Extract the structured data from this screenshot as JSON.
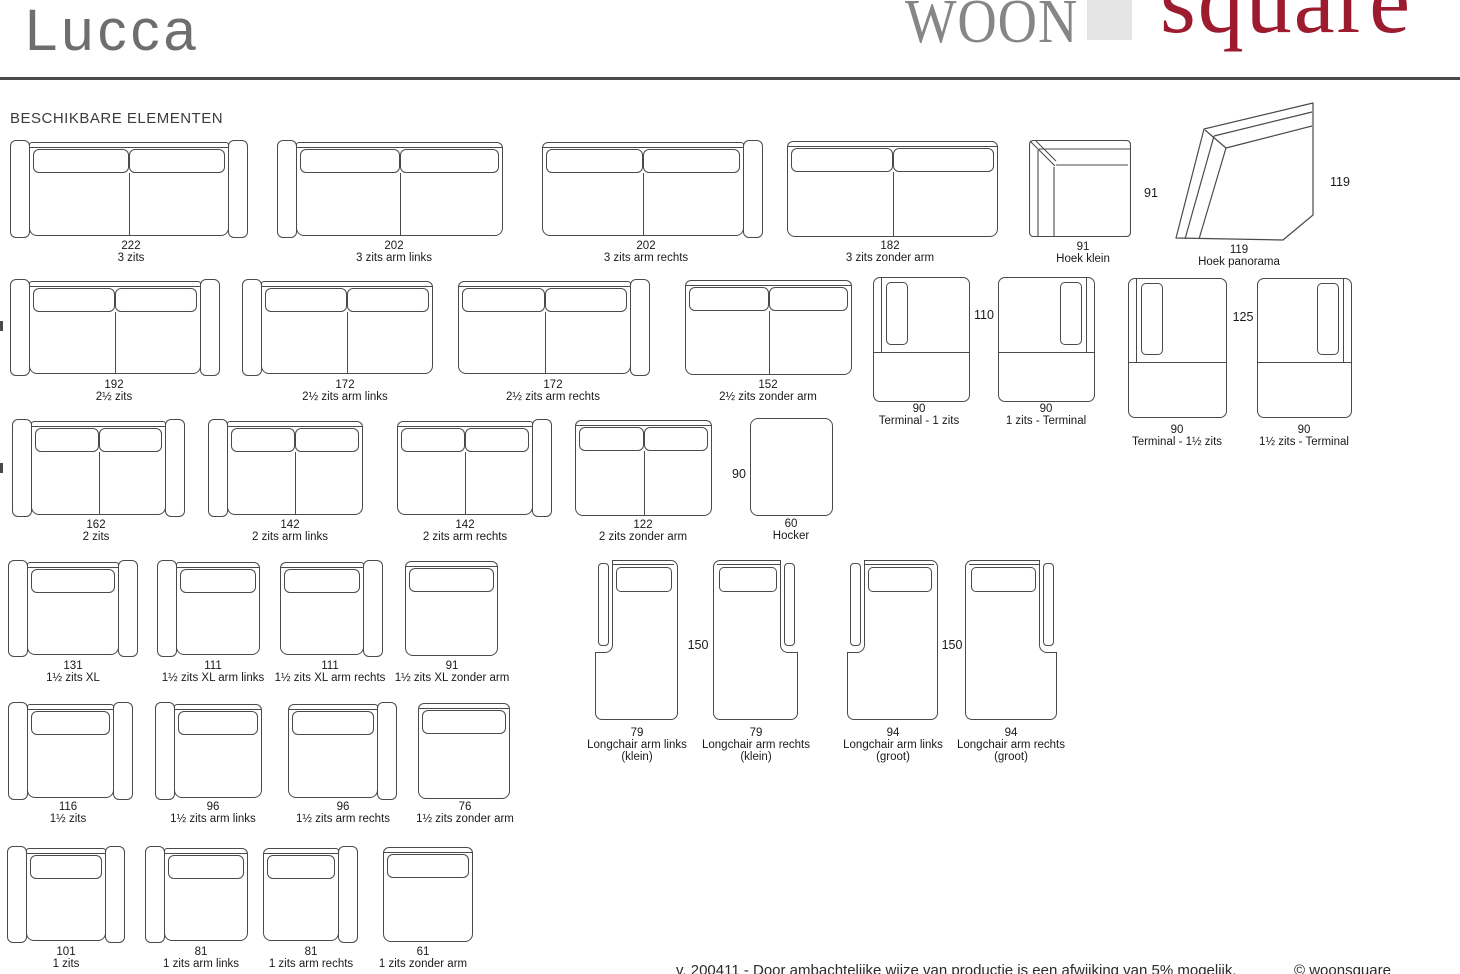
{
  "header": {
    "product_title": "Lucca",
    "brand_woon": "WOON",
    "brand_square": "square",
    "brand_red": "#9c1b2e",
    "brand_gray": "#868686"
  },
  "section": {
    "title": "BESCHIKBARE ELEMENTEN"
  },
  "footer": {
    "note": "v. 200411 - Door ambachtelijke wijze van productie is een afwijking van 5% mogelijk.",
    "copyright": "© woonsquare"
  },
  "diagram": {
    "line_color": "#4a4a4a",
    "items": [
      {
        "type": "sofa",
        "x": 10,
        "y": 140,
        "w": 238,
        "h": 98,
        "arms": "both",
        "cushions": 2,
        "size": "222",
        "name": "3 zits",
        "label_cx": 131,
        "label_y": 240
      },
      {
        "type": "sofa",
        "x": 277,
        "y": 140,
        "w": 226,
        "h": 98,
        "arms": "left",
        "cushions": 2,
        "size": "202",
        "name": "3 zits arm links",
        "label_cx": 394,
        "label_y": 240
      },
      {
        "type": "sofa",
        "x": 542,
        "y": 140,
        "w": 221,
        "h": 98,
        "arms": "right",
        "cushions": 2,
        "size": "202",
        "name": "3 zits arm rechts",
        "label_cx": 646,
        "label_y": 240
      },
      {
        "type": "sofa",
        "x": 787,
        "y": 140,
        "w": 211,
        "h": 98,
        "arms": "none",
        "cushions": 2,
        "size": "182",
        "name": "3 zits zonder arm",
        "label_cx": 890,
        "label_y": 240
      },
      {
        "type": "corner_klein",
        "x": 1029,
        "y": 140,
        "w": 102,
        "h": 97,
        "size": "91",
        "name": "Hoek klein",
        "label_cx": 1083,
        "label_y": 241,
        "side_dim": {
          "text": "91",
          "cx": 1151,
          "cy": 193
        }
      },
      {
        "type": "corner_panorama",
        "x": 1172,
        "y": 98,
        "w": 146,
        "h": 148,
        "size": "119",
        "name": "Hoek panorama",
        "label_cx": 1239,
        "label_y": 244,
        "side_dim": {
          "text": "119",
          "cx": 1340,
          "cy": 182
        }
      },
      {
        "type": "sofa",
        "x": 10,
        "y": 279,
        "w": 210,
        "h": 97,
        "arms": "both",
        "cushions": 2,
        "size": "192",
        "name": "2½ zits",
        "label_cx": 114,
        "label_y": 379
      },
      {
        "type": "sofa",
        "x": 242,
        "y": 279,
        "w": 191,
        "h": 97,
        "arms": "left",
        "cushions": 2,
        "size": "172",
        "name": "2½ zits arm links",
        "label_cx": 345,
        "label_y": 379
      },
      {
        "type": "sofa",
        "x": 458,
        "y": 279,
        "w": 192,
        "h": 97,
        "arms": "right",
        "cushions": 2,
        "size": "172",
        "name": "2½ zits arm rechts",
        "label_cx": 553,
        "label_y": 379
      },
      {
        "type": "sofa",
        "x": 685,
        "y": 279,
        "w": 167,
        "h": 97,
        "arms": "none",
        "cushions": 2,
        "size": "152",
        "name": "2½ zits zonder arm",
        "label_cx": 768,
        "label_y": 379
      },
      {
        "type": "terminal",
        "x": 873,
        "y": 277,
        "w": 97,
        "h": 125,
        "arm": "left",
        "size": "90",
        "name": "Terminal - 1 zits",
        "label_cx": 919,
        "label_y": 403,
        "side_dim": {
          "text": "110",
          "cx": 984,
          "cy": 315
        }
      },
      {
        "type": "terminal",
        "x": 998,
        "y": 277,
        "w": 97,
        "h": 125,
        "arm": "right",
        "size": "90",
        "name": "1 zits - Terminal",
        "label_cx": 1046,
        "label_y": 403
      },
      {
        "type": "terminal",
        "x": 1128,
        "y": 278,
        "w": 99,
        "h": 140,
        "arm": "left",
        "size": "90",
        "name": "Terminal - 1½ zits",
        "label_cx": 1177,
        "label_y": 424,
        "side_dim": {
          "text": "125",
          "cx": 1243,
          "cy": 317
        }
      },
      {
        "type": "terminal",
        "x": 1257,
        "y": 278,
        "w": 95,
        "h": 140,
        "arm": "right",
        "size": "90",
        "name": "1½ zits - Terminal",
        "label_cx": 1304,
        "label_y": 424
      },
      {
        "type": "sofa",
        "x": 12,
        "y": 419,
        "w": 173,
        "h": 98,
        "arms": "both",
        "cushions": 2,
        "size": "162",
        "name": "2 zits",
        "label_cx": 96,
        "label_y": 519
      },
      {
        "type": "sofa",
        "x": 208,
        "y": 419,
        "w": 155,
        "h": 98,
        "arms": "left",
        "cushions": 2,
        "size": "142",
        "name": "2 zits arm links",
        "label_cx": 290,
        "label_y": 519
      },
      {
        "type": "sofa",
        "x": 397,
        "y": 419,
        "w": 155,
        "h": 98,
        "arms": "right",
        "cushions": 2,
        "size": "142",
        "name": "2 zits arm rechts",
        "label_cx": 465,
        "label_y": 519
      },
      {
        "type": "sofa",
        "x": 575,
        "y": 419,
        "w": 137,
        "h": 98,
        "arms": "none",
        "cushions": 2,
        "size": "122",
        "name": "2 zits zonder arm",
        "label_cx": 643,
        "label_y": 519
      },
      {
        "type": "hocker",
        "x": 750,
        "y": 418,
        "w": 83,
        "h": 98,
        "size": "60",
        "name": "Hocker",
        "label_cx": 791,
        "label_y": 518,
        "side_dim": {
          "text": "90",
          "cx": 739,
          "cy": 474
        }
      },
      {
        "type": "sofa",
        "x": 8,
        "y": 560,
        "w": 130,
        "h": 97,
        "arms": "both",
        "cushions": 1,
        "size": "131",
        "name": "1½ zits XL",
        "label_cx": 73,
        "label_y": 660
      },
      {
        "type": "sofa",
        "x": 157,
        "y": 560,
        "w": 103,
        "h": 97,
        "arms": "left",
        "cushions": 1,
        "size": "111",
        "name": "1½ zits XL arm links",
        "label_cx": 213,
        "label_y": 660
      },
      {
        "type": "sofa",
        "x": 280,
        "y": 560,
        "w": 103,
        "h": 97,
        "arms": "right",
        "cushions": 1,
        "size": "111",
        "name": "1½ zits XL arm rechts",
        "label_cx": 330,
        "label_y": 660
      },
      {
        "type": "sofa",
        "x": 405,
        "y": 560,
        "w": 93,
        "h": 97,
        "arms": "none",
        "cushions": 1,
        "size": "91",
        "name": "1½ zits XL zonder arm",
        "label_cx": 452,
        "label_y": 660
      },
      {
        "type": "longchair",
        "x": 595,
        "y": 560,
        "w": 83,
        "h": 160,
        "arm": "left",
        "size": "79",
        "name": "Longchair arm links",
        "name2": "(klein)",
        "label_cx": 637,
        "label_y": 727,
        "side_dim": {
          "text": "150",
          "cx": 698,
          "cy": 645
        }
      },
      {
        "type": "longchair",
        "x": 713,
        "y": 560,
        "w": 85,
        "h": 160,
        "arm": "right",
        "size": "79",
        "name": "Longchair arm rechts",
        "name2": "(klein)",
        "label_cx": 756,
        "label_y": 727
      },
      {
        "type": "longchair",
        "x": 847,
        "y": 560,
        "w": 91,
        "h": 160,
        "arm": "left",
        "size": "94",
        "name": "Longchair arm links",
        "name2": "(groot)",
        "label_cx": 893,
        "label_y": 727,
        "side_dim": {
          "text": "150",
          "cx": 952,
          "cy": 645
        }
      },
      {
        "type": "longchair",
        "x": 965,
        "y": 560,
        "w": 92,
        "h": 160,
        "arm": "right",
        "size": "94",
        "name": "Longchair arm rechts",
        "name2": "(groot)",
        "label_cx": 1011,
        "label_y": 727
      },
      {
        "type": "sofa",
        "x": 8,
        "y": 702,
        "w": 125,
        "h": 98,
        "arms": "both",
        "cushions": 1,
        "size": "116",
        "name": "1½ zits",
        "label_cx": 68,
        "label_y": 801
      },
      {
        "type": "sofa",
        "x": 155,
        "y": 702,
        "w": 107,
        "h": 98,
        "arms": "left",
        "cushions": 1,
        "size": "96",
        "name": "1½ zits arm links",
        "label_cx": 213,
        "label_y": 801
      },
      {
        "type": "sofa",
        "x": 288,
        "y": 702,
        "w": 109,
        "h": 98,
        "arms": "right",
        "cushions": 1,
        "size": "96",
        "name": "1½ zits arm rechts",
        "label_cx": 343,
        "label_y": 801
      },
      {
        "type": "sofa",
        "x": 418,
        "y": 702,
        "w": 92,
        "h": 98,
        "arms": "none",
        "cushions": 1,
        "size": "76",
        "name": "1½ zits zonder arm",
        "label_cx": 465,
        "label_y": 801
      },
      {
        "type": "sofa",
        "x": 7,
        "y": 846,
        "w": 118,
        "h": 97,
        "arms": "both",
        "cushions": 1,
        "size": "101",
        "name": "1 zits",
        "label_cx": 66,
        "label_y": 946
      },
      {
        "type": "sofa",
        "x": 145,
        "y": 846,
        "w": 103,
        "h": 97,
        "arms": "left",
        "cushions": 1,
        "size": "81",
        "name": "1 zits arm links",
        "label_cx": 201,
        "label_y": 946
      },
      {
        "type": "sofa",
        "x": 263,
        "y": 846,
        "w": 95,
        "h": 97,
        "arms": "right",
        "cushions": 1,
        "size": "81",
        "name": "1 zits arm rechts",
        "label_cx": 311,
        "label_y": 946
      },
      {
        "type": "sofa",
        "x": 383,
        "y": 846,
        "w": 90,
        "h": 97,
        "arms": "none",
        "cushions": 1,
        "size": "61",
        "name": "1 zits zonder arm",
        "label_cx": 423,
        "label_y": 946
      }
    ],
    "edge_fragments": [
      {
        "x": 0,
        "y": 321
      },
      {
        "x": 0,
        "y": 463
      }
    ]
  }
}
